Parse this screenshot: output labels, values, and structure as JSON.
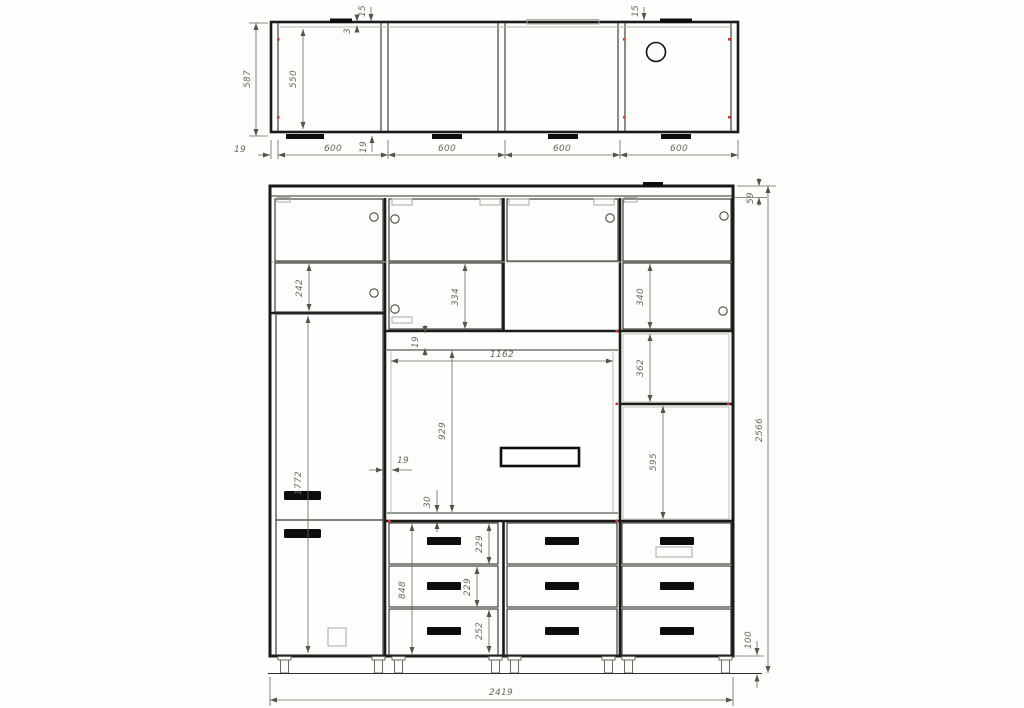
{
  "colors": {
    "bg": "#fdfdfb",
    "line": "#1a1a18",
    "dim": "#68685f",
    "red": "#e0352b",
    "handle": "#0d0d0d"
  },
  "top_view": {
    "total_depth": "587",
    "inner_depth": "550",
    "wall_thickness": "19",
    "bottom_panel": "19",
    "door_offset": "15",
    "door_gap": "3",
    "door_offset_right": "15",
    "sections": [
      "600",
      "600",
      "600",
      "600"
    ]
  },
  "front_view": {
    "total_width": "2419",
    "total_height": "2566",
    "top_offset": "59",
    "plinth_height": "100",
    "left_top_door": "242",
    "mid_top_door": "334",
    "right_top_door": "340",
    "wardrobe_door": "1772",
    "niche_width": "1162",
    "niche_height": "929",
    "niche_top_panel": "19",
    "niche_wall": "19",
    "niche_bottom_gap": "30",
    "right_shelf": "362",
    "right_cavity": "595",
    "drawer_top": "229",
    "drawer_mid": "229",
    "drawer_bottom": "252",
    "drawer_stack": "848"
  }
}
